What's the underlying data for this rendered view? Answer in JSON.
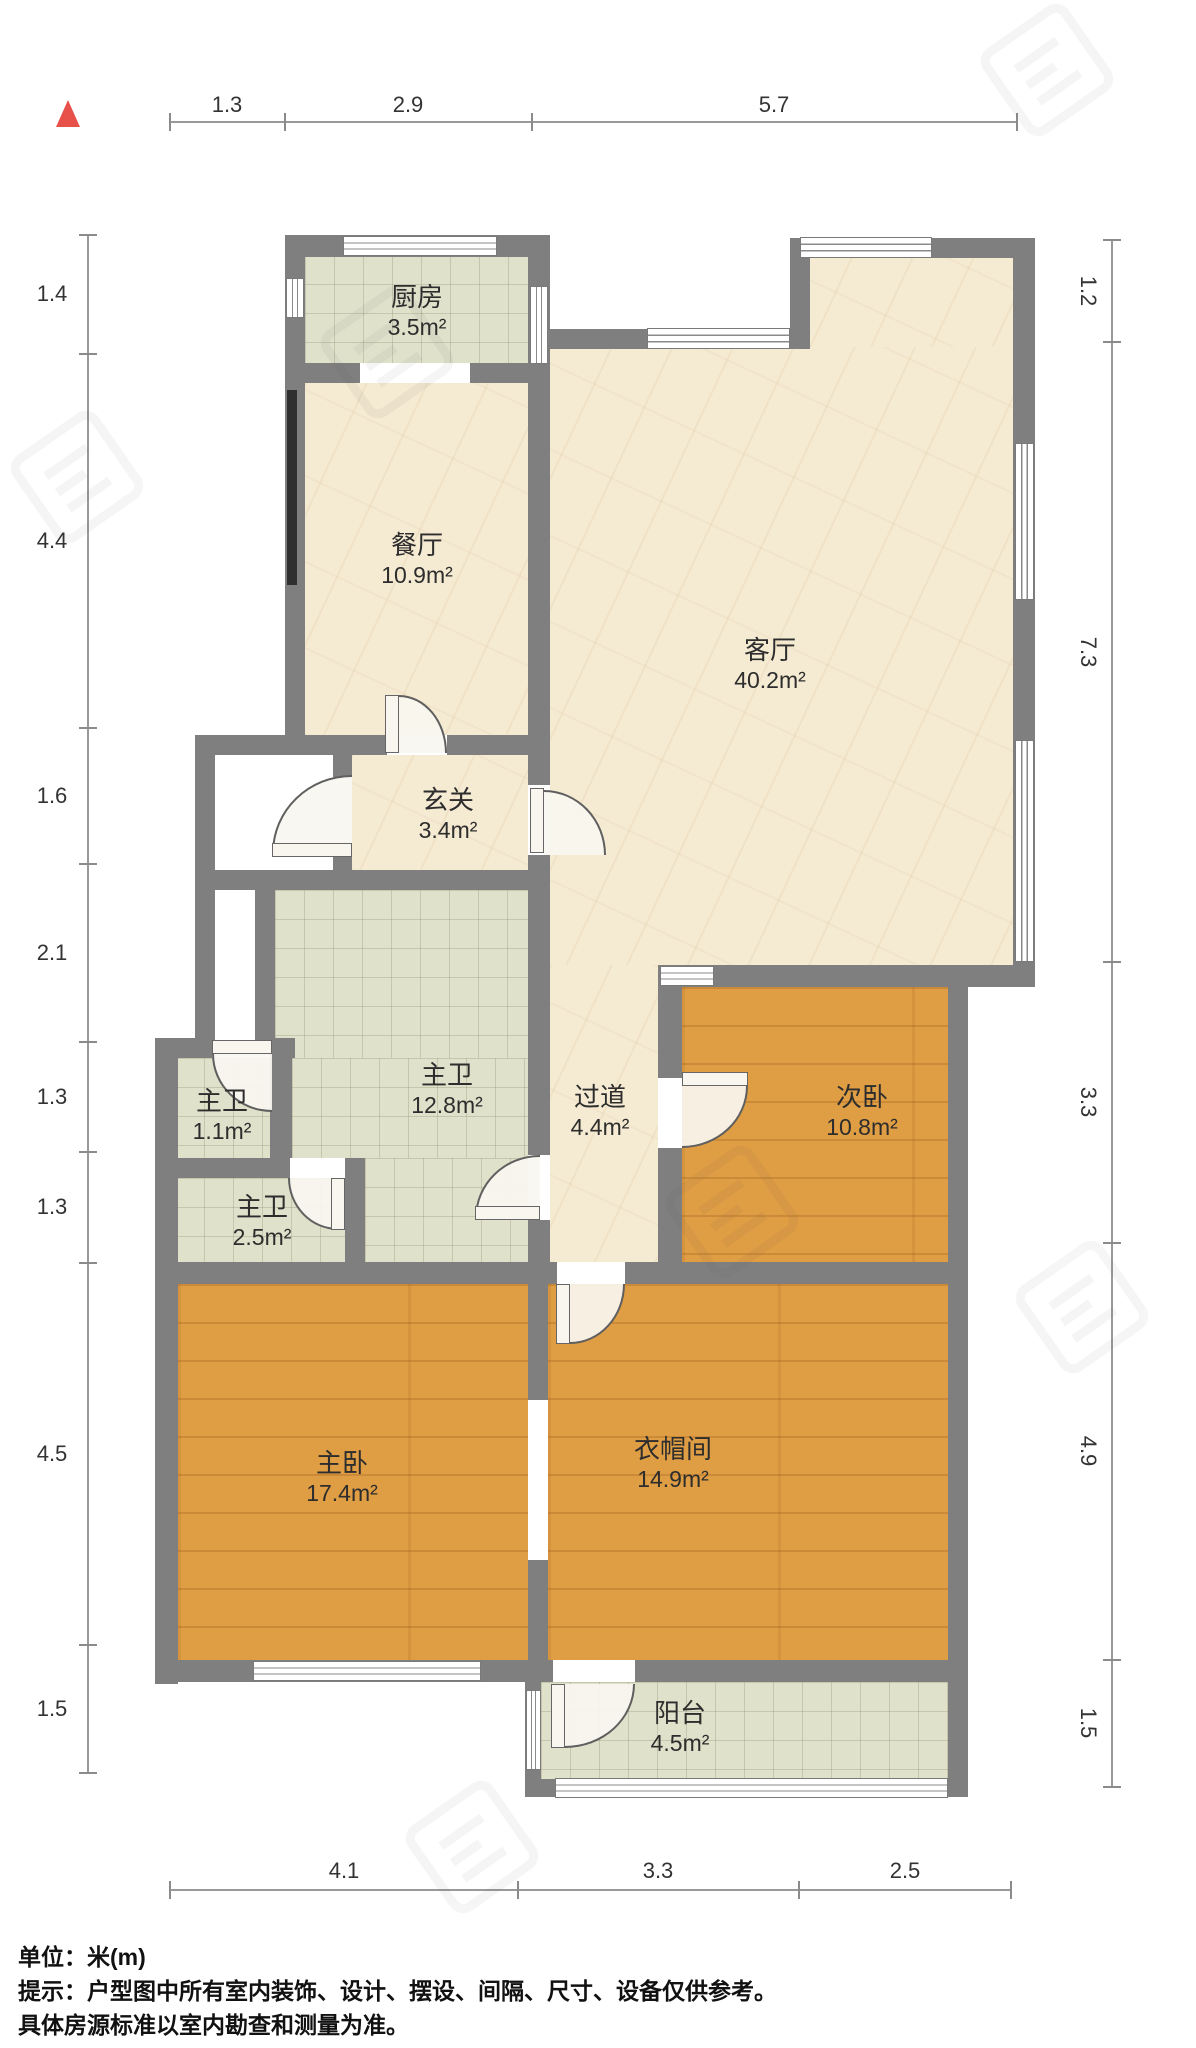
{
  "plan": {
    "type": "residential-floor-plan",
    "unit": "米(m)",
    "north_indicator": "up",
    "rooms": [
      {
        "id": "kitchen",
        "name": "厨房",
        "area": "3.5m²",
        "floor": "tile"
      },
      {
        "id": "dining",
        "name": "餐厅",
        "area": "10.9m²",
        "floor": "marble"
      },
      {
        "id": "living",
        "name": "客厅",
        "area": "40.2m²",
        "floor": "marble"
      },
      {
        "id": "foyer",
        "name": "玄关",
        "area": "3.4m²",
        "floor": "marble"
      },
      {
        "id": "master-bath",
        "name": "主卫",
        "area": "12.8m²",
        "floor": "tile"
      },
      {
        "id": "bath-small",
        "name": "主卫",
        "area": "1.1m²",
        "floor": "tile"
      },
      {
        "id": "bath-mid",
        "name": "主卫",
        "area": "2.5m²",
        "floor": "tile"
      },
      {
        "id": "hallway",
        "name": "过道",
        "area": "4.4m²",
        "floor": "marble"
      },
      {
        "id": "second-bedroom",
        "name": "次卧",
        "area": "10.8m²",
        "floor": "wood"
      },
      {
        "id": "master-bedroom",
        "name": "主卧",
        "area": "17.4m²",
        "floor": "wood"
      },
      {
        "id": "walk-in-closet",
        "name": "衣帽间",
        "area": "14.9m²",
        "floor": "wood"
      },
      {
        "id": "balcony",
        "name": "阳台",
        "area": "4.5m²",
        "floor": "tile"
      }
    ],
    "dimensions": {
      "top": [
        "1.3",
        "2.9",
        "5.7"
      ],
      "left": [
        "1.4",
        "4.4",
        "1.6",
        "2.1",
        "1.3",
        "1.3",
        "4.5",
        "1.5"
      ],
      "right": [
        "1.2",
        "7.3",
        "3.3",
        "4.9",
        "1.5"
      ],
      "bottom": [
        "4.1",
        "3.3",
        "2.5"
      ]
    },
    "footer": {
      "line1": "单位：米(m)",
      "line2": "提示：户型图中所有室内装饰、设计、摆设、间隔、尺寸、设备仅供参考。",
      "line3": "具体房源标准以室内勘查和测量为准。"
    },
    "colors": {
      "wall": "#7f7f7f",
      "marble_floor": "#f5ead2",
      "tile_floor": "#e0e1ca",
      "wood_floor": "#df9d44",
      "north_arrow": "#e8504a",
      "text": "#2d2d2d"
    }
  }
}
